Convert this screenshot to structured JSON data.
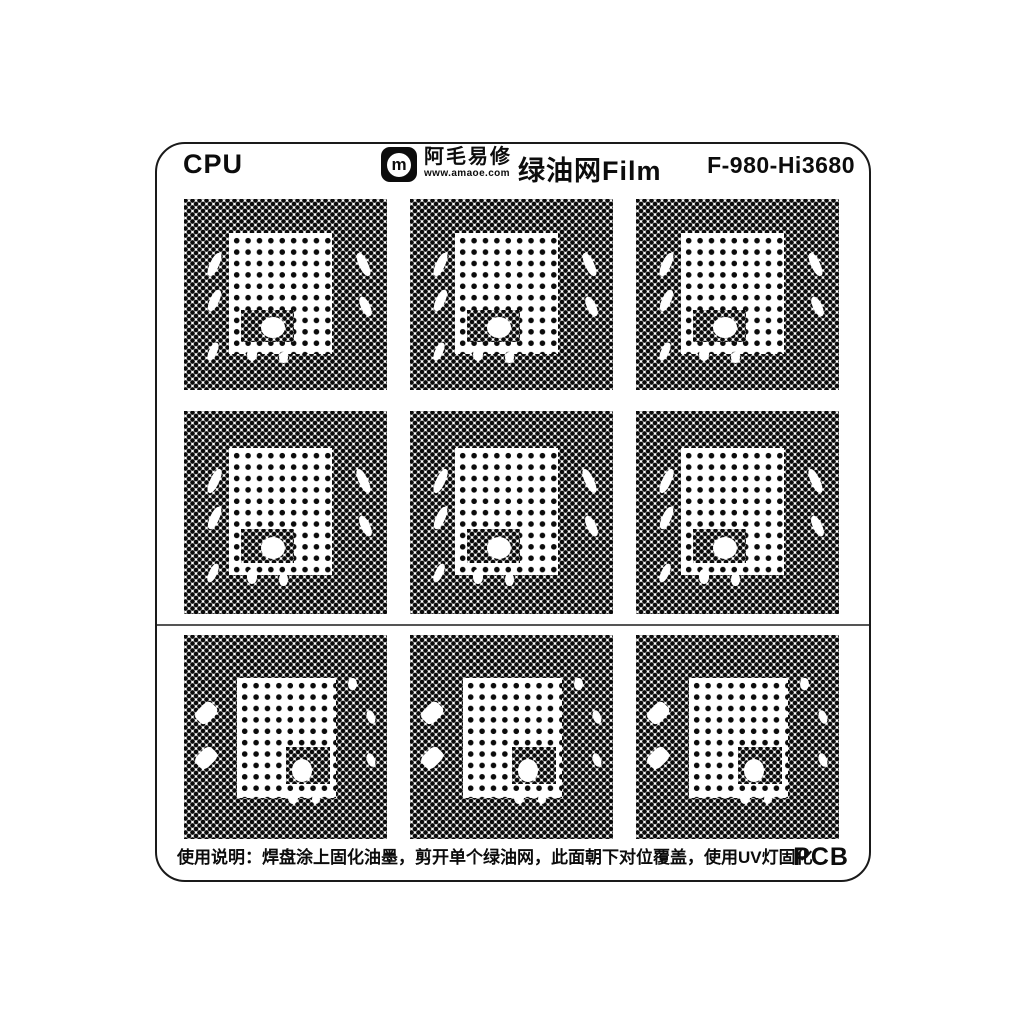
{
  "header": {
    "cpu_label": "CPU",
    "brand": {
      "symbol": "m",
      "name": "阿毛易修",
      "url": "www.amaoe.com"
    },
    "product_title": "绿油网Film",
    "model": "F-980-Hi3680"
  },
  "footer": {
    "instructions": "使用说明：焊盘涂上固化油墨，剪开单个绿油网，此面朝下对位覆盖，使用UV灯固化",
    "pcb_label": "PCB"
  },
  "colors": {
    "dot": "#0b0b0b",
    "card_border": "#1a1a1a",
    "divider": "#555555",
    "background": "#ffffff"
  },
  "stencil_grid": {
    "rows": 3,
    "cols": 3,
    "row_variants": [
      "A",
      "A",
      "B"
    ],
    "variants": {
      "A": {
        "inner": {
          "x": 22,
          "y": 18,
          "w": 51,
          "h": 63
        },
        "dense_patches": [
          {
            "x": 28,
            "y": 58,
            "w": 26,
            "h": 17
          }
        ],
        "blobs": [
          {
            "x": 13,
            "y": 28,
            "w": 4.5,
            "h": 13,
            "rot": 25,
            "r": 45
          },
          {
            "x": 13,
            "y": 47,
            "w": 4.5,
            "h": 12,
            "rot": 25,
            "r": 45
          },
          {
            "x": 12.5,
            "y": 75,
            "w": 4,
            "h": 10,
            "rot": 25,
            "r": 45
          },
          {
            "x": 86,
            "y": 28,
            "w": 4.5,
            "h": 13,
            "rot": -25,
            "r": 45
          },
          {
            "x": 87,
            "y": 51,
            "w": 4.5,
            "h": 11,
            "rot": -25,
            "r": 45
          },
          {
            "x": 38,
            "y": 62,
            "w": 12,
            "h": 11,
            "rot": 0,
            "r": 50
          },
          {
            "x": 31,
            "y": 78,
            "w": 5,
            "h": 7,
            "rot": 0,
            "r": 50
          },
          {
            "x": 47,
            "y": 80,
            "w": 4,
            "h": 6,
            "rot": 0,
            "r": 50
          }
        ]
      },
      "B": {
        "inner": {
          "x": 26,
          "y": 21,
          "w": 49,
          "h": 59
        },
        "dense_patches": [
          {
            "x": 50,
            "y": 55,
            "w": 22,
            "h": 18
          }
        ],
        "blobs": [
          {
            "x": 7,
            "y": 33,
            "w": 8,
            "h": 11,
            "rot": 45,
            "r": 30
          },
          {
            "x": 7,
            "y": 55,
            "w": 8,
            "h": 11,
            "rot": 45,
            "r": 30
          },
          {
            "x": 53,
            "y": 61,
            "w": 10,
            "h": 11,
            "rot": 0,
            "r": 50
          },
          {
            "x": 81,
            "y": 21,
            "w": 4,
            "h": 6,
            "rot": 0,
            "r": 50
          },
          {
            "x": 90,
            "y": 37,
            "w": 4,
            "h": 7,
            "rot": -20,
            "r": 50
          },
          {
            "x": 90,
            "y": 58,
            "w": 4,
            "h": 7,
            "rot": -20,
            "r": 50
          },
          {
            "x": 51,
            "y": 77,
            "w": 5,
            "h": 6,
            "rot": 0,
            "r": 50
          },
          {
            "x": 63,
            "y": 78,
            "w": 4,
            "h": 5,
            "rot": 0,
            "r": 50
          }
        ]
      }
    }
  }
}
